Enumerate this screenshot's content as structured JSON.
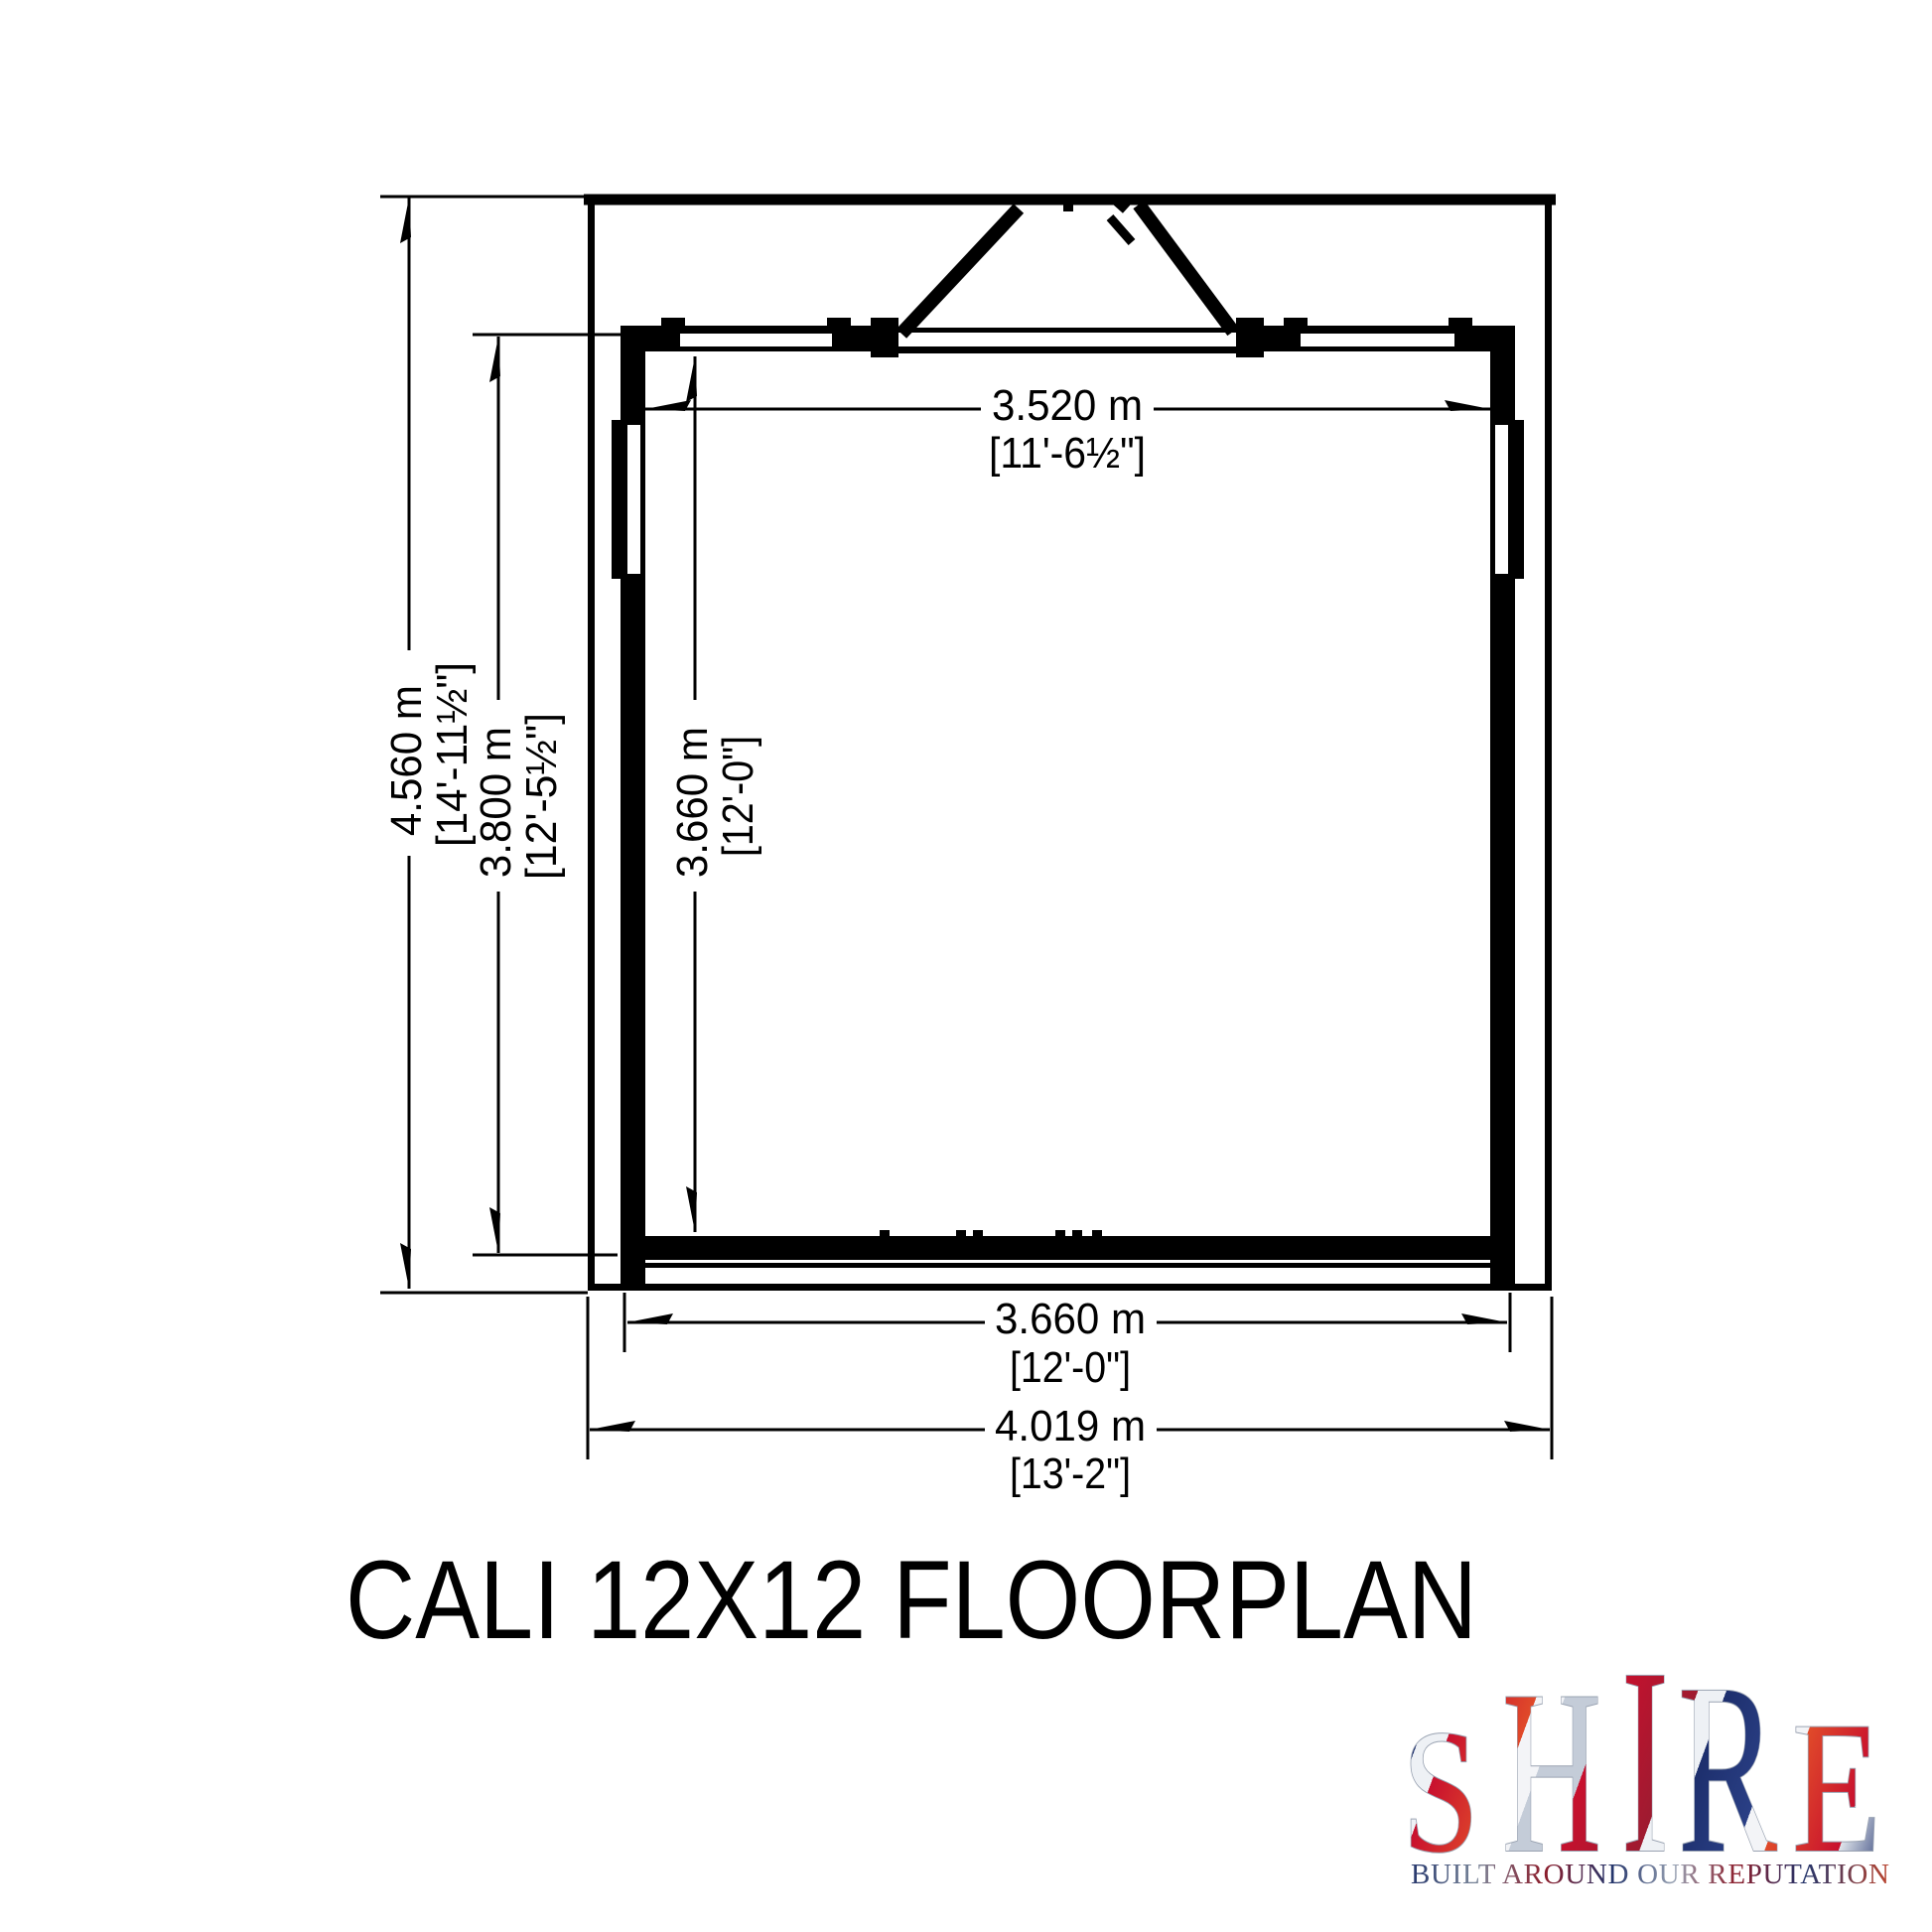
{
  "page": {
    "background": "#ffffff",
    "ink": "#000000"
  },
  "title": "CALI 12X12 FLOORPLAN",
  "drawing": {
    "name": "floorplan",
    "dims": {
      "overall_depth": {
        "m": "4.560 m",
        "ft": "[14'-11½\"]"
      },
      "building_depth": {
        "m": "3.800 m",
        "ft": "[12'-5½\"]"
      },
      "interior_depth": {
        "m": "3.660 m",
        "ft": "[12'-0\"]"
      },
      "interior_width": {
        "m": "3.520 m",
        "ft": "[11'-6½\"]"
      },
      "building_width": {
        "m": "3.660 m",
        "ft": "[12'-0\"]"
      },
      "overall_width": {
        "m": "4.019 m",
        "ft": "[13'-2\"]"
      }
    }
  },
  "logo": {
    "letters": [
      "S",
      "H",
      "I",
      "R",
      "E"
    ],
    "tagline": "BUILT AROUND OUR REPUTATION",
    "flag_red": "#c8102e",
    "flag_navy": "#1d2f6d",
    "flag_silver": "#c4ccd8"
  }
}
